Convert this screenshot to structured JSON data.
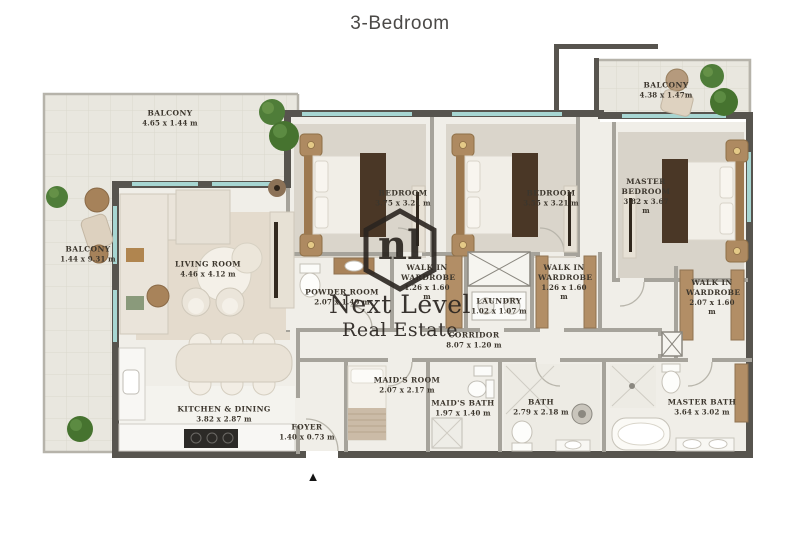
{
  "title": "3-Bedroom",
  "watermark": {
    "logo_text": "nl",
    "line1": "Next Level",
    "line2": "Real Estate"
  },
  "entrance_marker": "▲",
  "rooms": {
    "balcony_top_left": {
      "name": "BALCONY",
      "dims": "4.65 x 1.44 m"
    },
    "balcony_left": {
      "name": "BALCONY",
      "dims": "1.44 x 9.31 m"
    },
    "balcony_top_right": {
      "name": "BALCONY",
      "dims": "4.38 x 1.47m"
    },
    "living_room": {
      "name": "LIVING ROOM",
      "dims": "4.46 x 4.12 m"
    },
    "bedroom_1": {
      "name": "BEDROOM",
      "dims": "3.75 x 3.21 m"
    },
    "bedroom_2": {
      "name": "BEDROOM",
      "dims": "3.55 x 3.21 m"
    },
    "master_bedroom": {
      "name": "MASTER BEDROOM",
      "dims": "3.82 x 3.67 m"
    },
    "walk_in_wardrobe_1": {
      "name": "WALK IN WARDROBE",
      "dims": "1.26 x 1.60 m"
    },
    "walk_in_wardrobe_2": {
      "name": "WALK IN WARDROBE",
      "dims": "1.26 x 1.60 m"
    },
    "walk_in_wardrobe_master": {
      "name": "WALK IN WARDROBE",
      "dims": "2.07 x 1.60 m"
    },
    "powder_room": {
      "name": "POWDER ROOM",
      "dims": "2.07 x 1.49 m"
    },
    "laundry": {
      "name": "LAUNDRY",
      "dims": "1.02 x 1.07 m"
    },
    "corridor": {
      "name": "CORRIDOR",
      "dims": "8.07 x 1.20 m"
    },
    "kitchen_dining": {
      "name": "KITCHEN & DINING",
      "dims": "3.82 x 2.87 m"
    },
    "foyer": {
      "name": "FOYER",
      "dims": "1.40 x 0.73 m"
    },
    "maids_room": {
      "name": "MAID'S ROOM",
      "dims": "2.07 x 2.17 m"
    },
    "maids_bath": {
      "name": "MAID'S BATH",
      "dims": "1.97 x 1.40 m"
    },
    "bath": {
      "name": "BATH",
      "dims": "2.79 x 2.18 m"
    },
    "master_bath": {
      "name": "MASTER BATH",
      "dims": "3.64 x 3.02 m"
    }
  },
  "colors": {
    "exterior_wall": "#57544e",
    "interior_wall": "#a6a39b",
    "floor": "#f0eee8",
    "balcony_floor": "#e9e7df",
    "window": "#a7d6d2",
    "wood": "#ae8a61",
    "dark_wood": "#4a3726",
    "plant": "#4f7d39",
    "watermark_text": "#2a2520"
  }
}
